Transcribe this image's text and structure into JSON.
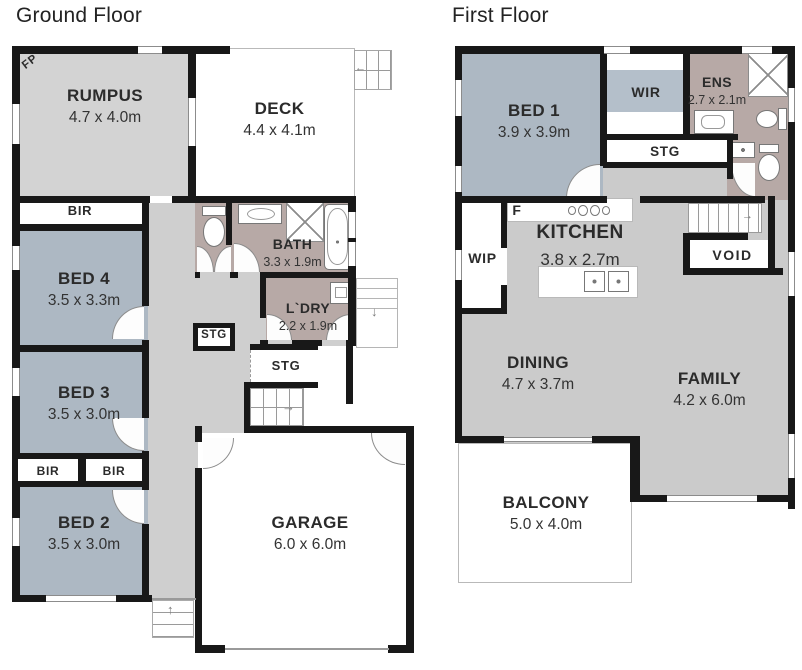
{
  "titles": {
    "ground": "Ground Floor",
    "first": "First Floor"
  },
  "arrows": {
    "up": "↑",
    "down": "↓",
    "right": "→",
    "left": "←"
  },
  "ground": {
    "fireplace": "FP",
    "rumpus": {
      "name": "RUMPUS",
      "dims": "4.7 x 4.0m"
    },
    "deck": {
      "name": "DECK",
      "dims": "4.4 x 4.1m"
    },
    "bir": "BIR",
    "bed4": {
      "name": "BED 4",
      "dims": "3.5 x 3.3m"
    },
    "bath": {
      "name": "BATH",
      "dims": "3.3 x 1.9m"
    },
    "ldry": {
      "name": "L`DRY",
      "dims": "2.2 x 1.9m"
    },
    "stg": "STG",
    "bed3": {
      "name": "BED 3",
      "dims": "3.5 x 3.0m"
    },
    "bed2": {
      "name": "BED 2",
      "dims": "3.5 x 3.0m"
    },
    "garage": {
      "name": "GARAGE",
      "dims": "6.0 x 6.0m"
    }
  },
  "first": {
    "bed1": {
      "name": "BED 1",
      "dims": "3.9 x 3.9m"
    },
    "wir": "WIR",
    "ens": {
      "name": "ENS",
      "dims": "2.7 x 2.1m"
    },
    "stg": "STG",
    "wip": "WIP",
    "fridge": "F",
    "kitchen": {
      "name": "KITCHEN",
      "dims": "3.8 x 2.7m"
    },
    "void": "VOID",
    "dining": {
      "name": "DINING",
      "dims": "4.7 x 3.7m"
    },
    "family": {
      "name": "FAMILY",
      "dims": "4.2 x 6.0m"
    },
    "balcony": {
      "name": "BALCONY",
      "dims": "5.0 x 4.0m"
    }
  },
  "colors": {
    "wall": "#181818",
    "room_gray": "#d3d3d3",
    "hall_gray": "#cfcfcf",
    "open_gray": "#cbcbcb",
    "bedroom_blue": "#adb8c3",
    "wet_area_mauve": "#b7a9a6",
    "robe_band_blue": "#b4bfca"
  }
}
